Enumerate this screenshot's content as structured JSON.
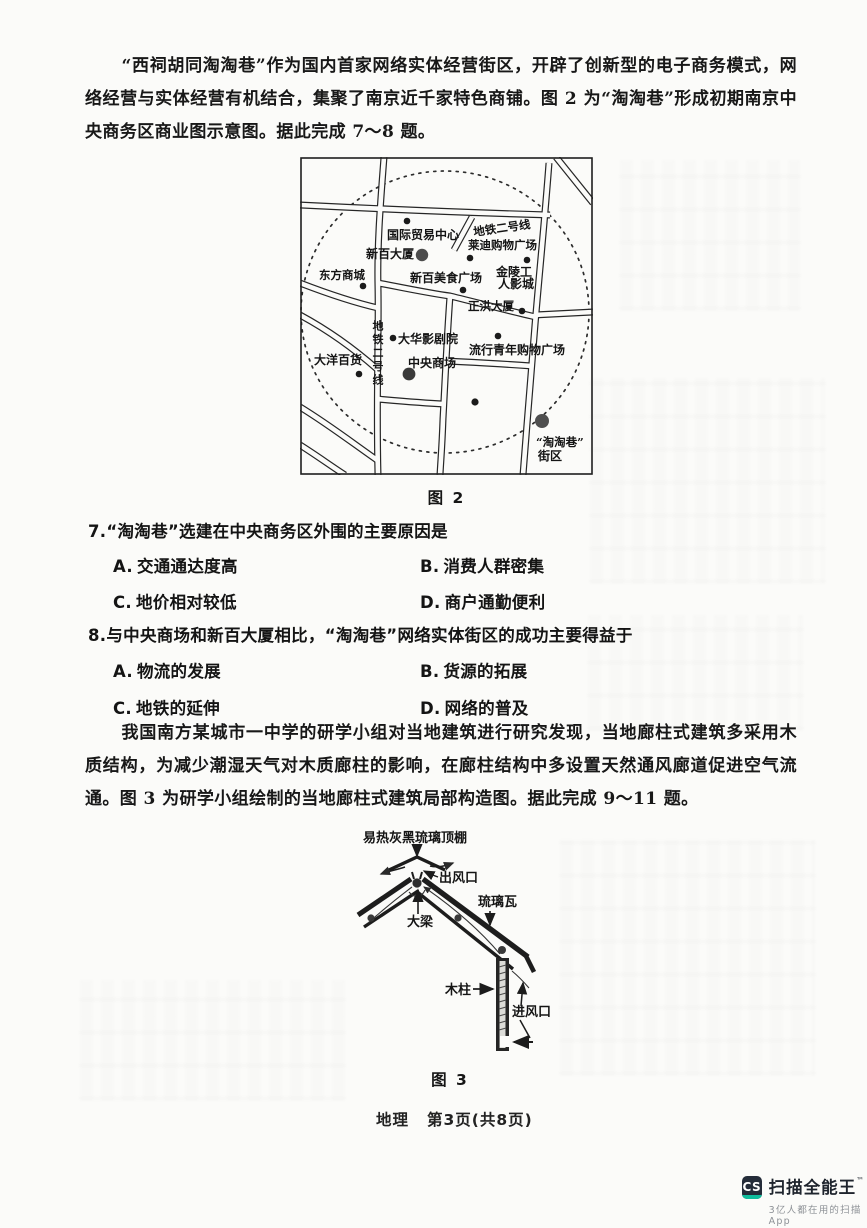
{
  "passage1": "“西祠胡同淘淘巷”作为国内首家网络实体经营街区，开辟了创新型的电子商务模式，网络经营与实体经营有机结合，集聚了南京近千家特色商铺。图 2 为“淘淘巷”形成初期南京中央商务区商业图示意图。据此完成 7～8 题。",
  "figure2": {
    "caption": "图 2",
    "labels": {
      "trade_center": "国际贸易中心",
      "metro_line_tr": "地铁二号线",
      "laidi": "莱迪购物广场",
      "xinbai_tower": "新百大厦",
      "dongfang": "东方商城",
      "xinbai_food": "新百美食广场",
      "jinling1": "金陵工",
      "jinling2": "人影城",
      "zhenghong": "正洪大厦",
      "metro_line_left": "地铁二号线",
      "dahua": "大华影剧院",
      "central_mall": "中央商场",
      "dayang": "大洋百货",
      "popular_youth": "流行青年购物广场",
      "taotao1": "“淘淘巷”",
      "taotao2": "街区"
    }
  },
  "q7": {
    "num": "7.",
    "stem": "“淘淘巷”选建在中央商务区外围的主要原因是",
    "options": [
      {
        "label": "A.",
        "text": "交通通达度高"
      },
      {
        "label": "B.",
        "text": "消费人群密集"
      },
      {
        "label": "C.",
        "text": "地价相对较低"
      },
      {
        "label": "D.",
        "text": "商户通勤便利"
      }
    ]
  },
  "q8": {
    "num": "8.",
    "stem": "与中央商场和新百大厦相比，“淘淘巷”网络实体街区的成功主要得益于",
    "options": [
      {
        "label": "A.",
        "text": "物流的发展"
      },
      {
        "label": "B.",
        "text": "货源的拓展"
      },
      {
        "label": "C.",
        "text": "地铁的延伸"
      },
      {
        "label": "D.",
        "text": "网络的普及"
      }
    ]
  },
  "passage2": "我国南方某城市一中学的研学小组对当地建筑进行研究发现，当地廊柱式建筑多采用木质结构，为减少潮湿天气对木质廊柱的影响，在廊柱结构中多设置天然通风廊道促进空气流通。图 3 为研学小组绘制的当地廊柱式建筑局部构造图。据此完成 9～11 题。",
  "figure3": {
    "caption": "图 3",
    "labels": {
      "roof_top": "易热灰黑琉璃顶棚",
      "outlet": "出风口",
      "glazed_tile": "琉璃瓦",
      "beam": "大梁",
      "wood_column": "木柱",
      "inlet": "进风口"
    }
  },
  "footer": {
    "subject": "地理",
    "page": "第3页(共8页)"
  },
  "watermark": {
    "icon_text": "CS",
    "title": "扫描全能王",
    "tm": "™",
    "subtitle": "3亿人都在用的扫描App"
  }
}
